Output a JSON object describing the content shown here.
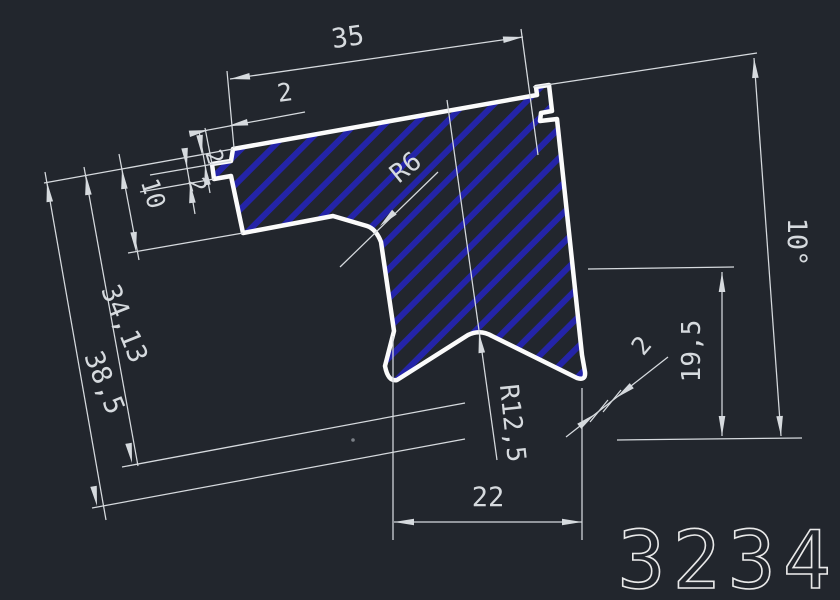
{
  "drawing": {
    "part_number": "3234",
    "dims": {
      "top_width": "35",
      "top_step": "2",
      "step1": "2",
      "step2": "2",
      "flange_depth": "10",
      "depth_mid": "34,13",
      "depth_total": "38,5",
      "fillet_radius": "R6",
      "arch_radius": "R12,5",
      "base_span": "22",
      "right_drop": "19,5",
      "lip_thickness": "2",
      "tilt_angle": "10°"
    },
    "colors": {
      "background": "#22262d",
      "outline": "#fbfbfb",
      "dimension_lines": "#d6dade",
      "hatch": "#2424a8"
    }
  }
}
